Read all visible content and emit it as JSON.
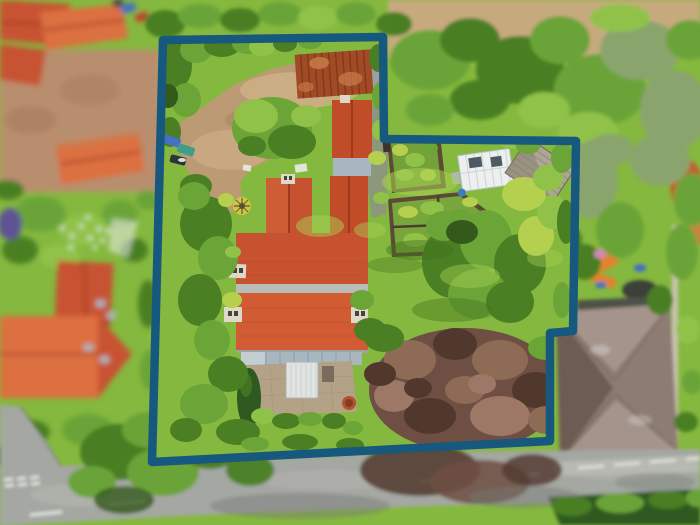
{
  "meta": {
    "width": 700,
    "height": 525,
    "scene_type": "aerial-property-photo-with-boundary-overlay"
  },
  "colors": {
    "boundary": "#17587f",
    "grassBase": "#85b83e",
    "grassLight": "#a8d052",
    "grassDark": "#628f2b",
    "lawnShadow": "#42701d",
    "g1": "#6ba437",
    "g2": "#4a7f24",
    "g3": "#90c24a",
    "g4": "#33591b",
    "g5": "#b5cf4e",
    "g6": "#8aa46e",
    "g7": "#2e5a20",
    "dirt": "#bc9b74",
    "dirtLight": "#d2b58c",
    "dirtDark": "#9c7c58",
    "roofRed": "#c75230",
    "roofRedLight": "#dd6f3f",
    "roofRedDark": "#9c3a1d",
    "roofOut": "#c14d28",
    "rust": "#a04b26",
    "rustDark": "#763114",
    "rustLight": "#c97e4b",
    "brick": "#b98e6e",
    "brickDark": "#a3785a",
    "road": "#a4a7a2",
    "roadLight": "#b8b9b2",
    "roadDark": "#767b76",
    "marking": "#edefe9",
    "stone": "#b4a287",
    "white": "#ecefee",
    "greyRoof": "#a7b6bf",
    "shed": "#aea694",
    "shedDark": "#857d6b",
    "slate": "#8d7b71",
    "slateLight": "#a5948b",
    "slateDark": "#6d5c53",
    "garage": "#4d5146",
    "copper": "#6f4f43",
    "copperLight": "#8d6b55",
    "copperDark": "#51382d",
    "copperPink": "#9d7866",
    "field": "#c6aa7d",
    "chimney": "#ded8c9",
    "chimneyDark": "#474238",
    "orange": "#e2832f",
    "blue": "#4570c4",
    "teal": "#3f9d8b",
    "purple": "#5e5296",
    "pink": "#d189b4",
    "red": "#c53b2b",
    "pathGrey": "#8d9483"
  },
  "boundary": {
    "points": "163,40 383,37 384,139 576,141 573,331 550,333 550,441 152,462",
    "stroke_width": 8.5
  },
  "driveway": {
    "points": "196,112 232,86 268,70 305,61 352,56 383,62 384,84 352,92 324,103 302,121 290,145 272,159 250,169 240,183 242,198 232,212 214,209 202,196 188,172 178,148 172,128"
  },
  "vegetation": {
    "inside": [
      [
        174,
        66,
        18,
        24,
        "g2"
      ],
      [
        196,
        50,
        16,
        13,
        "g1"
      ],
      [
        222,
        46,
        18,
        11,
        "g2"
      ],
      [
        248,
        44,
        16,
        10,
        "g1"
      ],
      [
        186,
        100,
        15,
        17,
        "g1"
      ],
      [
        170,
        132,
        11,
        15,
        "g2"
      ],
      [
        168,
        96,
        10,
        12,
        "g4"
      ],
      [
        262,
        47,
        13,
        9,
        "g3"
      ],
      [
        285,
        44,
        12,
        8,
        "g2"
      ],
      [
        310,
        42,
        12,
        7,
        "g1"
      ],
      [
        378,
        58,
        9,
        14,
        "g2"
      ],
      [
        380,
        96,
        8,
        14,
        "g1"
      ],
      [
        379,
        130,
        7,
        10,
        "g3"
      ],
      [
        272,
        128,
        40,
        31,
        "g1"
      ],
      [
        256,
        116,
        22,
        17,
        "g3"
      ],
      [
        292,
        142,
        24,
        17,
        "g2"
      ],
      [
        306,
        116,
        15,
        11,
        "g3"
      ],
      [
        252,
        146,
        14,
        10,
        "g2"
      ],
      [
        196,
        186,
        16,
        12,
        "g2"
      ],
      [
        206,
        224,
        26,
        28,
        "g2"
      ],
      [
        194,
        196,
        16,
        14,
        "g1"
      ],
      [
        218,
        258,
        20,
        22,
        "g1"
      ],
      [
        200,
        300,
        22,
        26,
        "g2"
      ],
      [
        212,
        340,
        18,
        20,
        "g1"
      ],
      [
        228,
        374,
        20,
        18,
        "g2"
      ],
      [
        204,
        404,
        24,
        20,
        "g1"
      ],
      [
        238,
        432,
        22,
        13,
        "g2"
      ],
      [
        186,
        430,
        16,
        12,
        "g2"
      ],
      [
        232,
        300,
        10,
        8,
        "g5"
      ],
      [
        226,
        200,
        8,
        7,
        "g5"
      ],
      [
        233,
        252,
        8,
        6,
        "g3"
      ],
      [
        263,
        416,
        12,
        8,
        "g3"
      ],
      [
        286,
        421,
        14,
        8,
        "g2"
      ],
      [
        310,
        419,
        12,
        7,
        "g1"
      ],
      [
        334,
        421,
        12,
        8,
        "g2"
      ],
      [
        353,
        428,
        10,
        7,
        "g1"
      ],
      [
        300,
        442,
        18,
        8,
        "g2"
      ],
      [
        255,
        444,
        14,
        7,
        "g1"
      ],
      [
        350,
        445,
        14,
        7,
        "g2"
      ],
      [
        377,
        158,
        9,
        7,
        "g5"
      ],
      [
        381,
        198,
        8,
        6,
        "g3"
      ],
      [
        452,
        262,
        30,
        36,
        "g2"
      ],
      [
        486,
        240,
        26,
        30,
        "g1"
      ],
      [
        520,
        264,
        26,
        30,
        "g2"
      ],
      [
        478,
        294,
        30,
        25,
        "g1"
      ],
      [
        510,
        302,
        24,
        21,
        "g2"
      ],
      [
        444,
        226,
        18,
        15,
        "g1"
      ],
      [
        536,
        236,
        18,
        20,
        "g5"
      ],
      [
        552,
        212,
        15,
        17,
        "g3"
      ],
      [
        462,
        232,
        16,
        12,
        "g4"
      ],
      [
        524,
        194,
        22,
        17,
        "g5"
      ],
      [
        548,
        178,
        15,
        13,
        "g3"
      ],
      [
        562,
        158,
        11,
        15,
        "g1"
      ],
      [
        566,
        222,
        9,
        22,
        "g2"
      ],
      [
        562,
        300,
        9,
        18,
        "g1"
      ],
      [
        510,
        140,
        12,
        9,
        "g3"
      ],
      [
        528,
        146,
        12,
        8,
        "g1"
      ],
      [
        420,
        250,
        34,
        10,
        "lawnShadow",
        0.45
      ],
      [
        452,
        310,
        40,
        12,
        "lawnShadow",
        0.4
      ],
      [
        395,
        265,
        28,
        8,
        "lawnShadow",
        0.35
      ],
      [
        420,
        182,
        38,
        14,
        "grassLight",
        0.55
      ],
      [
        470,
        276,
        30,
        12,
        "grassLight",
        0.45
      ],
      [
        320,
        226,
        24,
        11,
        "grassLight",
        0.5
      ],
      [
        545,
        258,
        18,
        9,
        "grassLight",
        0.4
      ],
      [
        370,
        230,
        16,
        8,
        "grassLight",
        0.45
      ],
      [
        465,
        390,
        96,
        62,
        "copper"
      ],
      [
        410,
        360,
        26,
        20,
        "copperLight"
      ],
      [
        455,
        344,
        22,
        16,
        "copperDark"
      ],
      [
        500,
        360,
        28,
        20,
        "copperLight"
      ],
      [
        536,
        390,
        24,
        18,
        "copperDark"
      ],
      [
        500,
        416,
        30,
        20,
        "copperPink"
      ],
      [
        430,
        416,
        26,
        18,
        "copperDark"
      ],
      [
        394,
        396,
        20,
        16,
        "copperPink"
      ],
      [
        465,
        390,
        20,
        14,
        "copperLight"
      ],
      [
        546,
        420,
        18,
        14,
        "copperLight"
      ],
      [
        380,
        374,
        16,
        12,
        "copperDark"
      ],
      [
        418,
        388,
        14,
        10,
        "copperDark"
      ],
      [
        482,
        384,
        14,
        10,
        "copperPink"
      ],
      [
        384,
        338,
        20,
        14,
        "g2"
      ],
      [
        546,
        348,
        18,
        12,
        "g1"
      ],
      [
        562,
        432,
        12,
        9,
        "g2"
      ],
      [
        370,
        330,
        16,
        12,
        "g2"
      ],
      [
        362,
        300,
        12,
        10,
        "g1"
      ]
    ],
    "left": [
      [
        40,
        214,
        26,
        18,
        "g1"
      ],
      [
        84,
        230,
        24,
        16,
        "g3"
      ],
      [
        120,
        214,
        18,
        14,
        "g1"
      ],
      [
        20,
        250,
        18,
        14,
        "g2"
      ],
      [
        60,
        256,
        20,
        12,
        "g3"
      ],
      [
        10,
        224,
        12,
        16,
        "purple"
      ],
      [
        134,
        250,
        14,
        12,
        "g2"
      ],
      [
        8,
        190,
        16,
        10,
        "g2"
      ],
      [
        148,
        200,
        12,
        10,
        "g1"
      ],
      [
        30,
        432,
        20,
        12,
        "g2"
      ],
      [
        88,
        430,
        26,
        16,
        "g1"
      ],
      [
        8,
        456,
        16,
        10,
        "g2"
      ],
      [
        148,
        304,
        10,
        24,
        "g2"
      ],
      [
        150,
        370,
        10,
        20,
        "g1"
      ]
    ],
    "top": [
      [
        165,
        24,
        20,
        14,
        "g2"
      ],
      [
        200,
        16,
        22,
        12,
        "g1"
      ],
      [
        240,
        20,
        20,
        12,
        "g2"
      ],
      [
        280,
        14,
        22,
        12,
        "g1"
      ],
      [
        318,
        18,
        20,
        12,
        "g3"
      ],
      [
        356,
        14,
        20,
        12,
        "g1"
      ],
      [
        394,
        24,
        18,
        12,
        "g2"
      ],
      [
        430,
        60,
        40,
        30,
        "g1"
      ],
      [
        470,
        40,
        30,
        22,
        "g2"
      ],
      [
        520,
        70,
        44,
        34,
        "g2"
      ],
      [
        560,
        40,
        30,
        24,
        "g1"
      ],
      [
        600,
        90,
        46,
        36,
        "g1"
      ],
      [
        640,
        50,
        40,
        30,
        "g6"
      ],
      [
        674,
        110,
        34,
        40,
        "g6"
      ],
      [
        620,
        18,
        30,
        14,
        "g3"
      ],
      [
        690,
        40,
        24,
        20,
        "g1"
      ],
      [
        588,
        132,
        30,
        20,
        "g3"
      ],
      [
        544,
        110,
        26,
        18,
        "g3"
      ],
      [
        480,
        100,
        30,
        20,
        "g2"
      ],
      [
        430,
        110,
        24,
        16,
        "g1"
      ],
      [
        610,
        150,
        24,
        16,
        "g6"
      ]
    ],
    "right": [
      [
        660,
        160,
        30,
        26,
        "g6"
      ],
      [
        692,
        200,
        18,
        26,
        "g1"
      ],
      [
        590,
        180,
        28,
        38,
        "g6"
      ],
      [
        620,
        230,
        24,
        28,
        "g1"
      ],
      [
        585,
        262,
        16,
        18,
        "g2"
      ],
      [
        682,
        252,
        16,
        28,
        "g1"
      ],
      [
        660,
        300,
        13,
        15,
        "g2"
      ],
      [
        688,
        330,
        12,
        14,
        "g3"
      ],
      [
        692,
        382,
        10,
        12,
        "g1"
      ],
      [
        686,
        422,
        12,
        10,
        "g2"
      ],
      [
        600,
        254,
        6,
        5,
        "pink"
      ],
      [
        613,
        262,
        5,
        4,
        "orange"
      ],
      [
        640,
        268,
        6,
        4,
        "blue"
      ],
      [
        570,
        240,
        12,
        14,
        "g2"
      ]
    ],
    "road": [
      [
        120,
        452,
        40,
        28,
        "g2"
      ],
      [
        163,
        472,
        36,
        24,
        "g1"
      ],
      [
        210,
        447,
        30,
        22,
        "g2"
      ],
      [
        150,
        430,
        28,
        18,
        "g1"
      ],
      [
        250,
        470,
        24,
        16,
        "g2",
        0.95
      ],
      [
        92,
        482,
        24,
        16,
        "g1"
      ],
      [
        124,
        500,
        30,
        14,
        "g4",
        0.8
      ],
      [
        420,
        470,
        60,
        26,
        "copperDark",
        0.85
      ],
      [
        480,
        482,
        50,
        22,
        "copper",
        0.85
      ],
      [
        532,
        470,
        30,
        16,
        "copperDark",
        0.8
      ],
      [
        300,
        506,
        90,
        13,
        "roadDark",
        0.45
      ],
      [
        524,
        497,
        56,
        11,
        "roadDark",
        0.45
      ],
      [
        655,
        482,
        40,
        9,
        "roadDark",
        0.35
      ],
      [
        572,
        506,
        20,
        10,
        "g2"
      ],
      [
        620,
        503,
        24,
        10,
        "g1"
      ],
      [
        668,
        500,
        20,
        9,
        "g2"
      ],
      [
        698,
        498,
        12,
        9,
        "g1"
      ]
    ]
  },
  "cars": {
    "inside": [
      [
        172,
        141,
        17,
        9,
        "blue",
        18
      ],
      [
        186,
        150,
        17,
        9,
        "teal",
        18
      ],
      [
        178,
        160,
        16,
        8,
        "#2e3338",
        14
      ]
    ],
    "top_left": [
      [
        128,
        8,
        15,
        9,
        "blue",
        -15
      ],
      [
        142,
        17,
        13,
        8,
        "red",
        -15
      ],
      [
        118,
        3,
        10,
        7,
        "#3a3f44",
        -10
      ]
    ]
  },
  "flowers": [
    [
      62,
      228
    ],
    [
      72,
      236
    ],
    [
      81,
      226
    ],
    [
      90,
      238
    ],
    [
      99,
      229
    ],
    [
      88,
      217
    ],
    [
      71,
      247
    ],
    [
      103,
      241
    ],
    [
      95,
      248
    ],
    [
      108,
      231
    ]
  ],
  "road_markings": {
    "centre_dashes": [
      [
        30,
        515,
        62,
        512
      ],
      [
        108,
        505,
        146,
        501
      ],
      [
        418,
        482,
        454,
        479
      ],
      [
        504,
        477,
        540,
        474
      ]
    ],
    "edge_dashes": [
      [
        578,
        468,
        604,
        466
      ],
      [
        614,
        465,
        640,
        463
      ],
      [
        650,
        462,
        676,
        460
      ],
      [
        686,
        459,
        700,
        458
      ]
    ],
    "give_way_dashes": [
      [
        4,
        480,
        13,
        479
      ],
      [
        17,
        479,
        26,
        478
      ],
      [
        30,
        478,
        39,
        477
      ],
      [
        5,
        486,
        14,
        485
      ],
      [
        18,
        485,
        27,
        484
      ],
      [
        31,
        484,
        40,
        483
      ]
    ]
  }
}
